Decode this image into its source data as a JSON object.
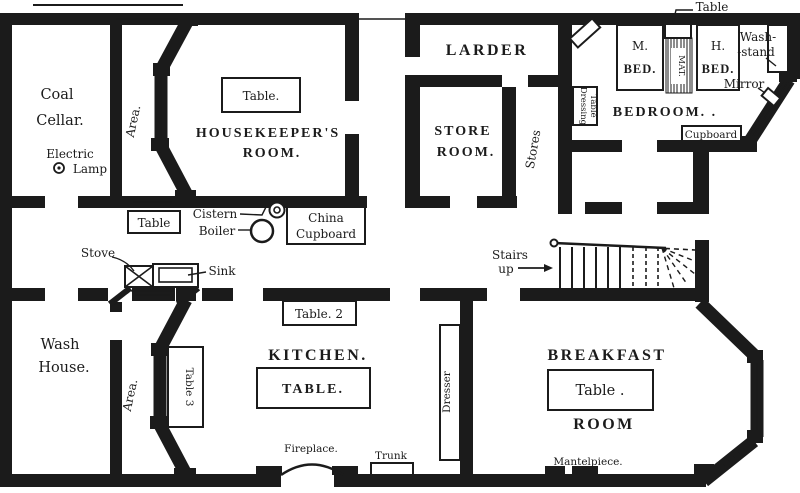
{
  "figure": {
    "type": "floor-plan",
    "paper_color": "#ffffff",
    "ink_color": "#1b1b1b"
  },
  "rooms": {
    "coal_cellar_1": "Coal",
    "coal_cellar_2": "Cellar.",
    "housekeepers_1": "HOUSEKEEPER'S",
    "housekeepers_2": "ROOM.",
    "larder": "LARDER",
    "store_room_1": "STORE",
    "store_room_2": "ROOM.",
    "stores": "Stores",
    "bedroom": "BEDROOM. .",
    "wash_house_1": "Wash",
    "wash_house_2": "House.",
    "kitchen": "KITCHEN.",
    "breakfast_1": "BREAKFAST",
    "breakfast_2": "ROOM"
  },
  "furniture": {
    "hk_table": "Table.",
    "passage_table": "Table",
    "cistern": "Cistern",
    "boiler": "Boiler",
    "china_1": "China",
    "china_2": "Cupboard",
    "stove": "Stove",
    "sink": "Sink",
    "kitchen_table": "TABLE.",
    "table2": "Table. 2",
    "table3": "Table 3",
    "fireplace": "Fireplace.",
    "trunk": "Trunk",
    "dresser": "Dresser",
    "bf_table": "Table .",
    "mantelpiece": "Mantelpiece.",
    "m_bed_1": "M.",
    "m_bed_2": "BED.",
    "h_bed_1": "H.",
    "h_bed_2": "BED.",
    "mat": "MAT.",
    "bed_table": "Table",
    "wash_stand_1": "Wash-",
    "wash_stand_2": "-stand",
    "mirror": "Mirror",
    "cupboard": "Cupboard",
    "dressing_1": "Dressing",
    "dressing_2": "Table"
  },
  "annotations": {
    "area_top": "Area.",
    "area_bottom": "Area.",
    "electric_1": "Electric",
    "electric_2": "Lamp",
    "stairs_1": "Stairs",
    "stairs_2": "up"
  }
}
